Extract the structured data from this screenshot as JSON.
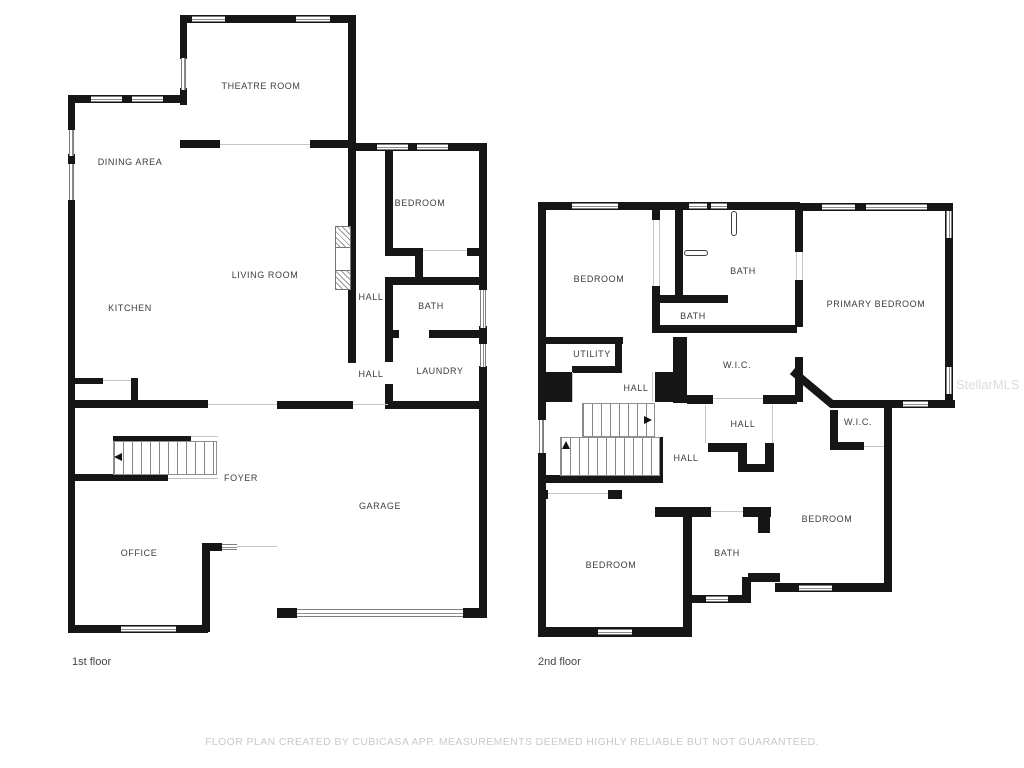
{
  "watermark": "StellarMLS",
  "footer": "FLOOR PLAN CREATED BY CUBICASA APP. MEASUREMENTS DEEMED HIGHLY RELIABLE BUT NOT GUARANTEED.",
  "floors": [
    {
      "caption": "1st floor",
      "rooms": [
        {
          "label": "THEATRE ROOM"
        },
        {
          "label": "DINING AREA"
        },
        {
          "label": "LIVING ROOM"
        },
        {
          "label": "KITCHEN"
        },
        {
          "label": "BEDROOM"
        },
        {
          "label": "HALL"
        },
        {
          "label": "BATH"
        },
        {
          "label": "HALL"
        },
        {
          "label": "LAUNDRY"
        },
        {
          "label": "FOYER"
        },
        {
          "label": "GARAGE"
        },
        {
          "label": "OFFICE"
        }
      ]
    },
    {
      "caption": "2nd floor",
      "rooms": [
        {
          "label": "BEDROOM"
        },
        {
          "label": "BATH"
        },
        {
          "label": "PRIMARY BEDROOM"
        },
        {
          "label": "BATH"
        },
        {
          "label": "UTILITY"
        },
        {
          "label": "W.I.C."
        },
        {
          "label": "HALL"
        },
        {
          "label": "HALL"
        },
        {
          "label": "W.I.C."
        },
        {
          "label": "HALL"
        },
        {
          "label": "BEDROOM"
        },
        {
          "label": "BATH"
        },
        {
          "label": "BEDROOM"
        }
      ]
    }
  ]
}
